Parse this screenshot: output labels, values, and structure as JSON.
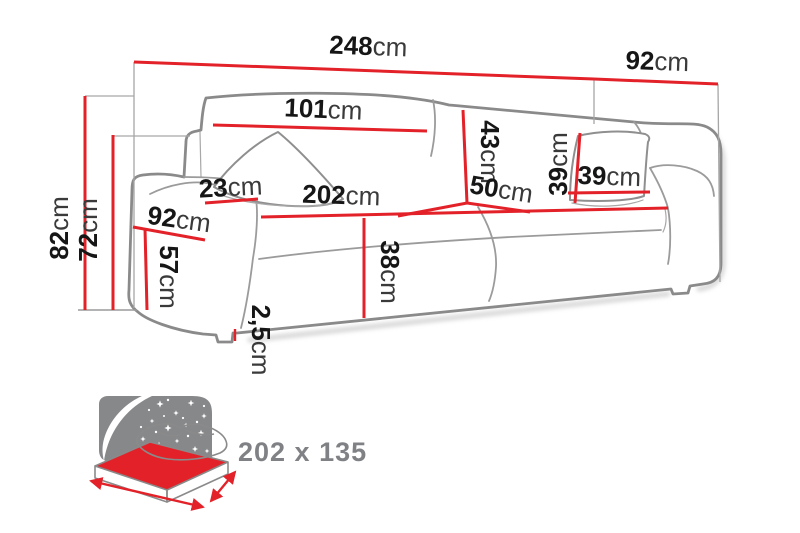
{
  "dims": {
    "total_width": {
      "v": "248",
      "u": "cm"
    },
    "total_depth": {
      "v": "92",
      "u": "cm"
    },
    "back_cushion_width": {
      "v": "101",
      "u": "cm"
    },
    "back_cushion_height": {
      "v": "43",
      "u": "cm"
    },
    "armrest_width": {
      "v": "23",
      "u": "cm"
    },
    "arm_side_depth": {
      "v": "92",
      "u": "cm"
    },
    "armrest_height": {
      "v": "57",
      "u": "cm"
    },
    "total_height": {
      "v": "82",
      "u": "cm"
    },
    "arm_height": {
      "v": "72",
      "u": "cm"
    },
    "seat_width": {
      "v": "202",
      "u": "cm"
    },
    "seat_depth": {
      "v": "50",
      "u": "cm"
    },
    "seat_height": {
      "v": "38",
      "u": "cm"
    },
    "pillow_height": {
      "v": "39",
      "u": "cm"
    },
    "pillow_width": {
      "v": "39",
      "u": "cm"
    },
    "leg_height": {
      "v": "2,5",
      "u": "cm"
    }
  },
  "sleeping_area": {
    "label": "202 x 135"
  },
  "colors": {
    "dimension_line": "#e32129",
    "outline_gray": "#8a8a8a",
    "number_text": "#161616",
    "unit_text": "#3a3a3a",
    "bed_icon_gray": "#87888a",
    "bed_icon_red": "#e32129",
    "sleeping_text": "#7f8184"
  }
}
